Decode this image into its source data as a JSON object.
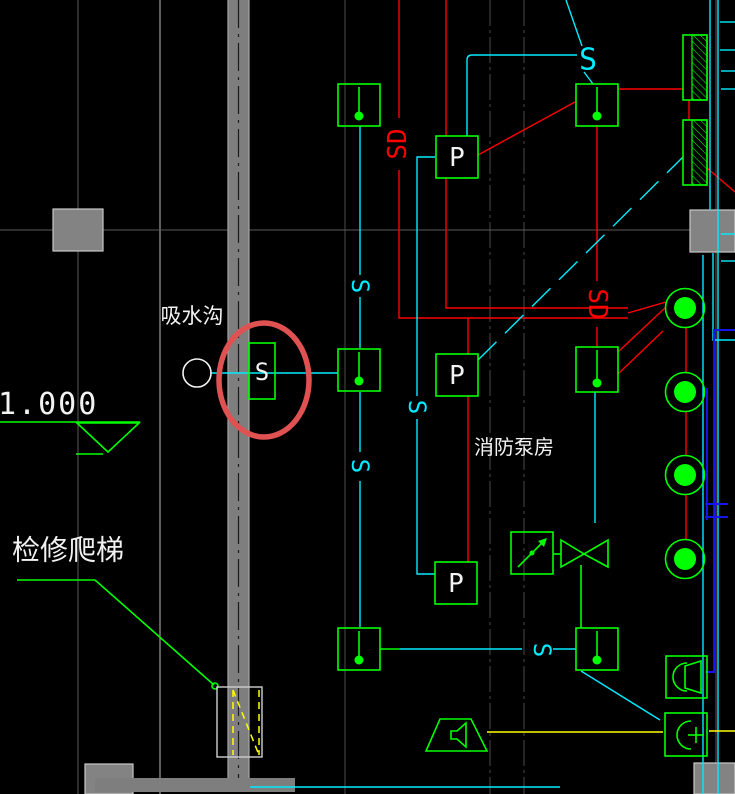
{
  "drawing": {
    "type": "cad-fire-protection-plan-detail",
    "background": "#000000"
  },
  "colors": {
    "device_green": "#00ff00",
    "signal_red": "#ff0000",
    "signal_cyan": "#00ecff",
    "pipe_blue": "#1414f0",
    "ladder_yellow": "#ffff00",
    "wall_gray": "#7e7e7e",
    "grid_gray": "#4a4a4a",
    "text_white": "#f2f2f2",
    "highlight_red": "#e05252"
  },
  "texts": {
    "elevation": "1.000",
    "suction_ditch": "吸水沟",
    "fire_pump_room": "消防泵房",
    "maintenance_ladder": "检修爬梯",
    "sd_1": "SD",
    "sd_2": "SD",
    "s_top": "S",
    "s_1": "S",
    "s_2": "S",
    "s_3": "S",
    "s_4": "S",
    "s_device": "S",
    "p_1": "P",
    "p_2": "P",
    "p_3": "P"
  }
}
